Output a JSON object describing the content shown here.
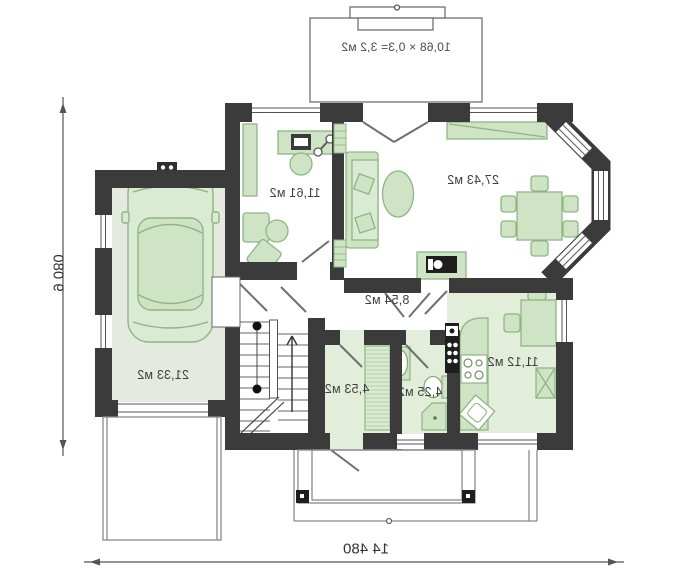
{
  "rooms": [
    {
      "id": "office",
      "area": "11,61 м2"
    },
    {
      "id": "living-room",
      "area": "27,43 м2"
    },
    {
      "id": "garage",
      "area": "21,33 м2"
    },
    {
      "id": "hall",
      "area": "8,54 м2"
    },
    {
      "id": "vestibule",
      "area": "4,53 м2"
    },
    {
      "id": "bathroom",
      "area": "4,25 м2"
    },
    {
      "id": "kitchen",
      "area": "11,12 м2"
    }
  ],
  "terrace": {
    "note": "10,68 × 0,3= 3,2 м2"
  },
  "dimensions": {
    "overall_width": "14 480",
    "overall_depth": "9 080"
  },
  "colors": {
    "wall": "#3b3b3b",
    "room_fill": "#e2eeda",
    "garage_fill": "#e4eae0",
    "furniture_fill": "#cfe4c4",
    "furniture_stroke": "#8db684",
    "line": "#6f6f6f",
    "label_text": "#3f3f3f"
  }
}
